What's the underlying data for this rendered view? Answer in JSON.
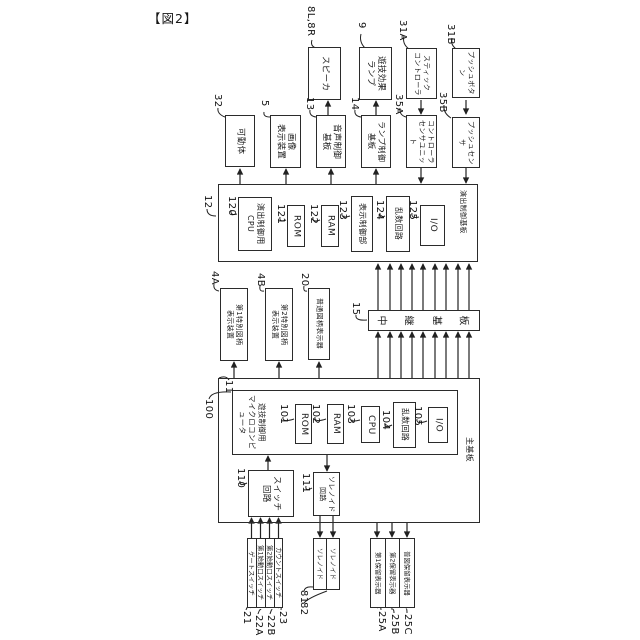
{
  "figure_label": "【図2】",
  "colors": {
    "ink": "#1f1f1f",
    "background": "#ffffff"
  },
  "top_devices": {
    "speaker": {
      "ref": "8L,8R",
      "label": "スピーカ"
    },
    "game_effect_lamp": {
      "ref": "9",
      "label": "遊技効果\nランプ"
    },
    "stick_controller": {
      "ref": "31A",
      "label": "スティック\nコントローラ"
    },
    "push_button": {
      "ref": "31B",
      "label": "プッシュボタン"
    }
  },
  "mid_devices": {
    "movable_body": {
      "ref": "32",
      "label": "可動体"
    },
    "image_display": {
      "ref": "5",
      "label": "画像\n表示装置"
    },
    "sound_control_board": {
      "ref": "13",
      "label": "音声制御\n基板"
    },
    "lamp_control_board": {
      "ref": "14",
      "label": "ランプ制御\n基板"
    },
    "controller_sensor_unit": {
      "ref": "35A",
      "label": "コントローラ\nセンサユニット"
    },
    "push_sensor": {
      "ref": "35B",
      "label": "プッシュセンサ"
    }
  },
  "effect_board": {
    "ref": "12",
    "name": "演出制御基板",
    "cpu": {
      "ref": "120",
      "label": "演出制御用\nCPU"
    },
    "rom": {
      "ref": "121",
      "label": "ROM"
    },
    "ram": {
      "ref": "122",
      "label": "RAM"
    },
    "display_control": {
      "ref": "123",
      "label": "表示制御部"
    },
    "random_circuit": {
      "ref": "124",
      "label": "乱数回路"
    },
    "io": {
      "ref": "125",
      "label": "I/O"
    }
  },
  "symbol_displays": {
    "special1": {
      "ref": "4A",
      "label": "第1特別図柄\n表示装置"
    },
    "special2": {
      "ref": "4B",
      "label": "第2特別図柄\n表示装置"
    },
    "normal": {
      "ref": "20",
      "label": "普通図柄表示器"
    }
  },
  "relay_board": {
    "ref": "15",
    "name": "中継基板",
    "chars": [
      "中",
      "継",
      "基",
      "板"
    ]
  },
  "main_board": {
    "ref": "11",
    "name": "主基板",
    "micro": {
      "ref": "100",
      "label": "遊技制御用\nマイクロコンピュータ"
    },
    "rom": {
      "ref": "101",
      "label": "ROM"
    },
    "ram": {
      "ref": "102",
      "label": "RAM"
    },
    "cpu": {
      "ref": "103",
      "label": "CPU"
    },
    "random_circuit": {
      "ref": "104",
      "label": "乱数回路"
    },
    "io": {
      "ref": "105",
      "label": "I/O"
    },
    "switch_circuit": {
      "ref": "110",
      "label": "スイッチ\n回路"
    },
    "solenoid_circuit": {
      "ref": "111",
      "label": "ソレノイド\n回路"
    }
  },
  "bottom_devices": {
    "gate_switch": {
      "ref": "21",
      "label": "ゲートスイッチ"
    },
    "start1_switch": {
      "ref": "22A",
      "label": "第1始動口スイッチ"
    },
    "start2_switch": {
      "ref": "22B",
      "label": "第2始動口スイッチ"
    },
    "count_switch": {
      "ref": "23",
      "label": "カウントスイッチ"
    },
    "solenoid1": {
      "ref": "81",
      "label": "ソレノイド"
    },
    "solenoid2": {
      "ref": "82",
      "label": "ソレノイド"
    },
    "hold_display1": {
      "ref": "25A",
      "label": "第1保留表示器"
    },
    "hold_display2": {
      "ref": "25B",
      "label": "第2保留表示器"
    },
    "normal_hold_display": {
      "ref": "25C",
      "label": "普図保留表示器"
    }
  }
}
